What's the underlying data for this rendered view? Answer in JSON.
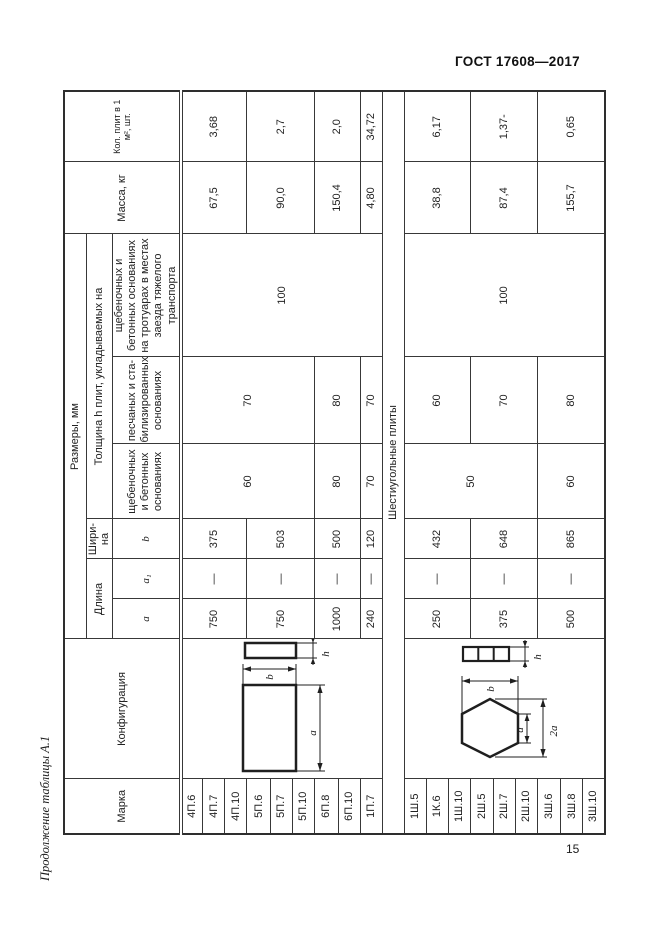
{
  "page": {
    "header_right": "ГОСТ 17608—2017",
    "caption": "Продолжение таблицы А.1",
    "page_number": "15"
  },
  "table": {
    "headers": {
      "marka": "Марка",
      "config": "Конфигурация",
      "razmery": "Размеры, мм",
      "dlina": "Длина",
      "shirina": "Шири-на",
      "tolshina": "Толщина h плит, укладываемых на",
      "a": "a",
      "a1": "a₁",
      "b": "b",
      "osn_shcheb": "щебеночных и бетонных основаниях",
      "osn_pesch": "песчаных и ста-билизированных основаниях",
      "osn_transport": "щебеночных и бетонных основаниях на тротуарах в местах заезда тяжелого транспорта",
      "massa": "Масса, кг",
      "kol": "Кол. плит в 1 м², шт."
    },
    "divider": "Шестиугольные плиты",
    "rows_left": [
      "4П.6",
      "4П.7",
      "4П.10",
      "5П.6",
      "5П.7",
      "5П.10",
      "6П.8",
      "6П.10",
      "1П.7"
    ],
    "rows_right": [
      "1Ш.5",
      "1К.6",
      "1Ш.10",
      "2Ш.5",
      "2Ш.7",
      "2Ш.10",
      "3Ш.6",
      "3Ш.8",
      "3Ш.10"
    ],
    "groups_left": [
      {
        "a": "750",
        "a1": "—",
        "b": "375",
        "mass": "67,5",
        "count": "3,68"
      },
      {
        "a": "750",
        "a1": "—",
        "b": "503",
        "mass": "90,0",
        "count": "2,7"
      },
      {
        "a": "1000",
        "a1": "—",
        "b": "500",
        "mass": "150,4",
        "count": "2,0"
      },
      {
        "a": "240",
        "a1": "—",
        "b": "120",
        "mass": "4,80",
        "count": "34,72"
      }
    ],
    "thickness_left": {
      "shcheb": "60",
      "shcheb_6p": "80",
      "shcheb_1p": "70",
      "pesch": "70",
      "pesch_6p": "80",
      "pesch_1p": "70",
      "transport": "100"
    },
    "groups_right": [
      {
        "a": "250",
        "a1": "—",
        "b": "432",
        "mass": "38,8",
        "count": "6,17"
      },
      {
        "a": "375",
        "a1": "—",
        "b": "648",
        "mass": "87,4",
        "count": "1,37-"
      },
      {
        "a": "500",
        "a1": "—",
        "b": "865",
        "mass": "155,7",
        "count": "0,65"
      }
    ],
    "thickness_right": {
      "shcheb": "50",
      "shcheb_3sh": "60",
      "pesch_1sh": "60",
      "pesch_2sh": "70",
      "pesch_3sh": "80",
      "transport": "100"
    },
    "figures": {
      "rect": {
        "a": "a",
        "b": "b",
        "h": "h"
      },
      "hex": {
        "a": "a",
        "b": "b",
        "h": "h",
        "a2": "2a"
      }
    }
  }
}
